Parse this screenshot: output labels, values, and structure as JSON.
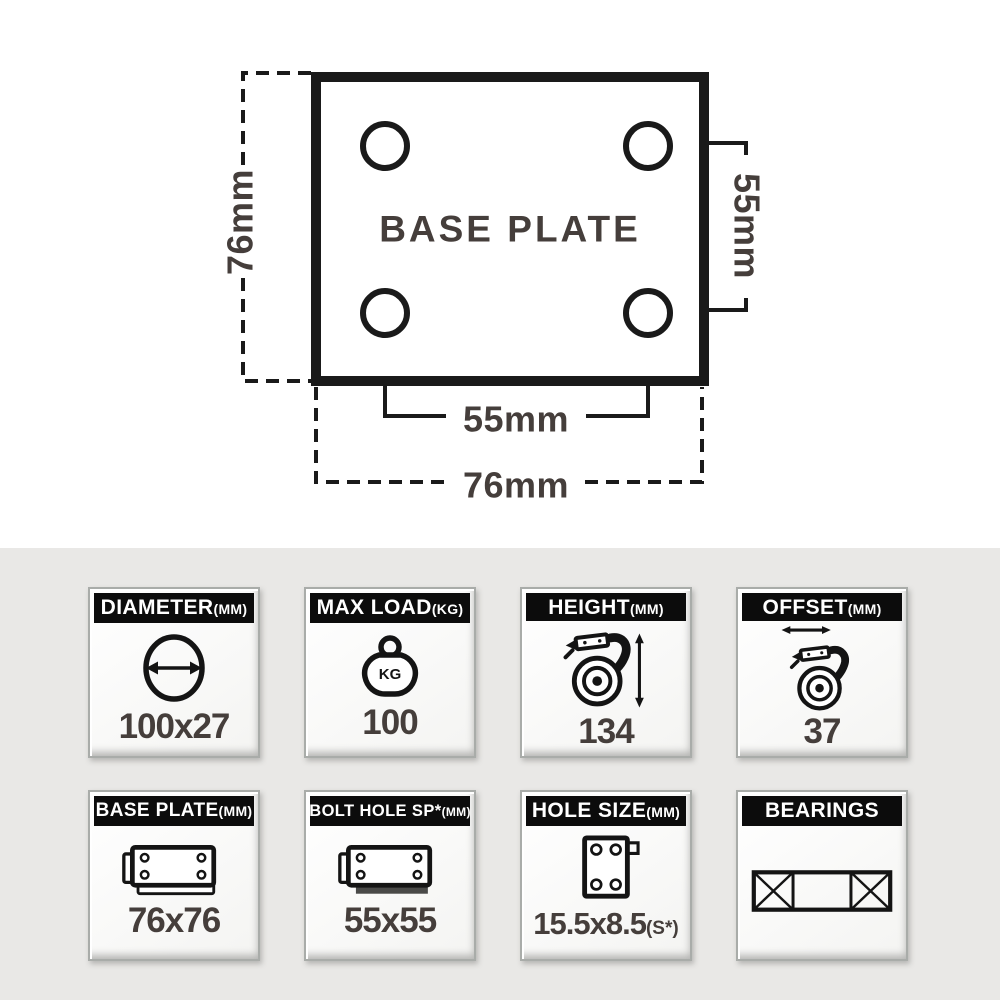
{
  "diagram": {
    "title": "BASE PLATE",
    "left_dim": "76mm",
    "right_dim": "55mm",
    "bolt_spacing_dim": "55mm",
    "plate_width_dim": "76mm"
  },
  "cards": [
    {
      "title": "DIAMETER",
      "unit": "(MM)",
      "value": "100x27"
    },
    {
      "title": "MAX LOAD",
      "unit": "(KG)",
      "value": "100",
      "icon_label": "KG"
    },
    {
      "title": "HEIGHT",
      "unit": "(MM)",
      "value": "134"
    },
    {
      "title": "OFFSET",
      "unit": "(MM)",
      "value": "37"
    },
    {
      "title": "BASE PLATE",
      "unit": "(MM)",
      "value": "76x76"
    },
    {
      "title": "BOLT HOLE SP*",
      "unit": "(MM)",
      "value": "55x55"
    },
    {
      "title": "HOLE SIZE",
      "unit": "(MM)",
      "value": "15.5x8.5",
      "value_suffix": "(S*)"
    },
    {
      "title": "BEARINGS",
      "unit": "",
      "value": ""
    }
  ],
  "colors": {
    "header_bg": "#0c0c0c",
    "header_text": "#ffffff",
    "value_text": "#453e3b",
    "line": "#1a1a1a",
    "section_bg": "#e9e8e6"
  }
}
